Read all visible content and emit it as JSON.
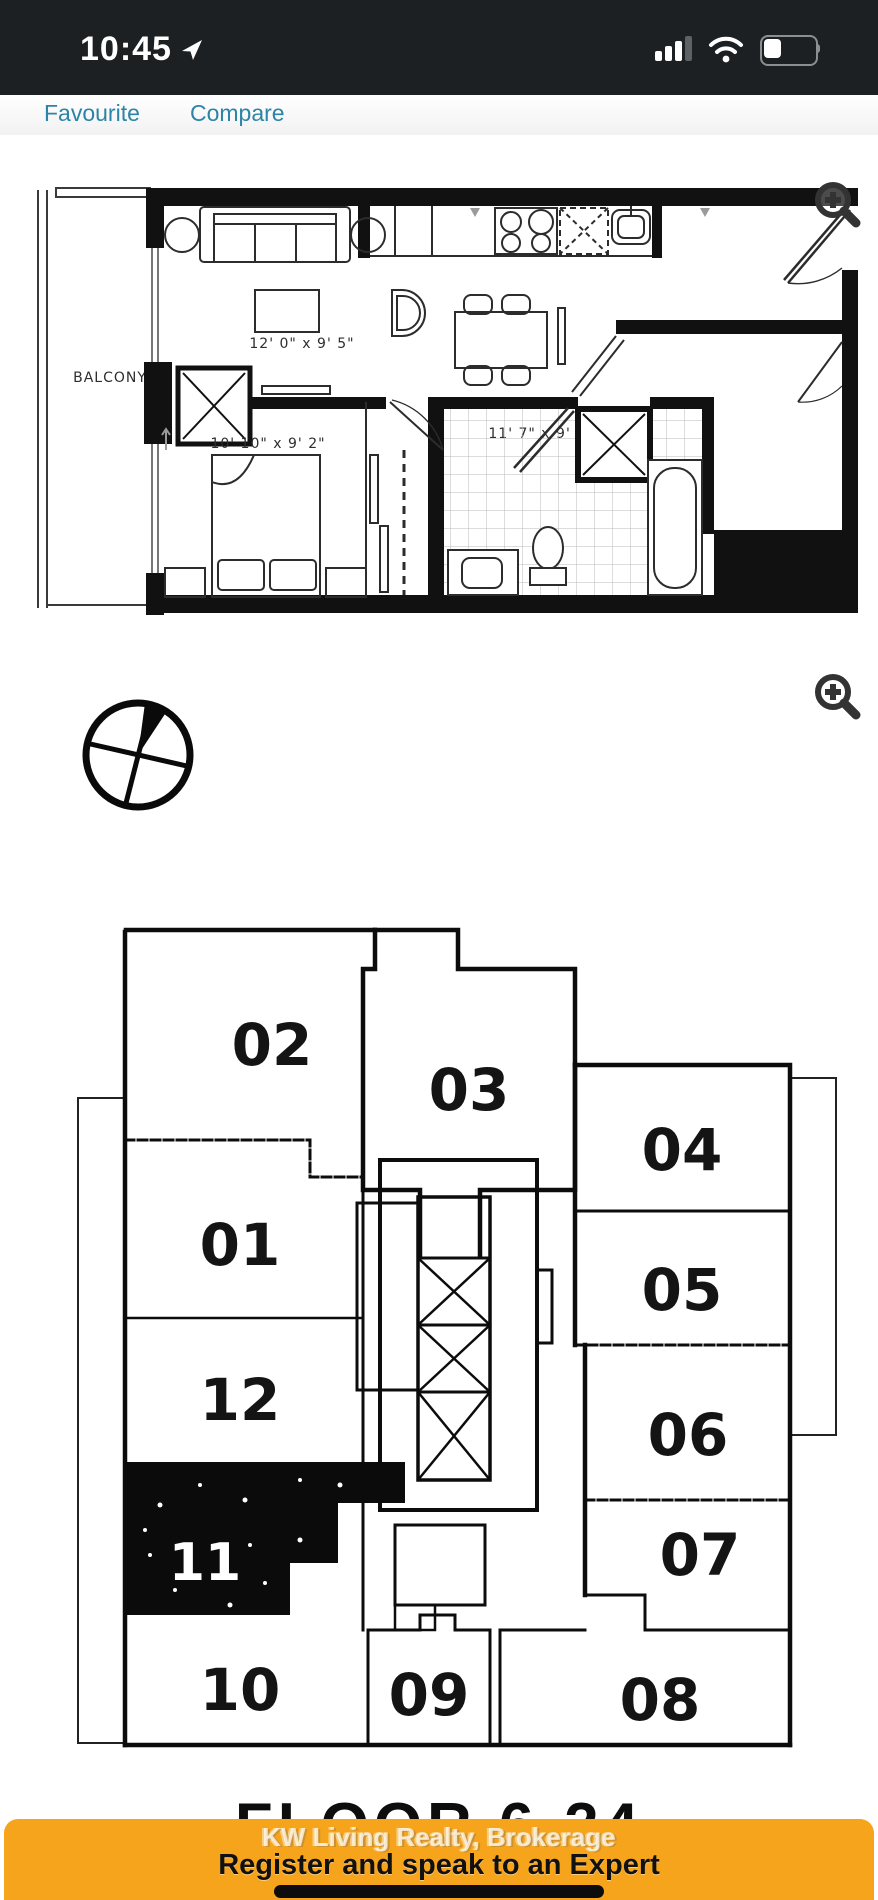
{
  "status_bar": {
    "time": "10:45"
  },
  "header": {
    "favourite_label": "Favourite",
    "compare_label": "Compare"
  },
  "floor_plan": {
    "balcony_label": "BALCONY",
    "living_dim": "12' 0\" x 9' 5\"",
    "kitchen_dim": "11' 7\" x 9' 5\"",
    "bedroom_dim": "10' 10\" x 9' 2\""
  },
  "key_plan": {
    "floor_label": "FLOOR 6-24",
    "highlighted_unit": "11",
    "units": [
      {
        "label": "02"
      },
      {
        "label": "03"
      },
      {
        "label": "04"
      },
      {
        "label": "01"
      },
      {
        "label": "05"
      },
      {
        "label": "12"
      },
      {
        "label": "06"
      },
      {
        "label": "11"
      },
      {
        "label": "07"
      },
      {
        "label": "10"
      },
      {
        "label": "09"
      },
      {
        "label": "08"
      }
    ]
  },
  "banner": {
    "watermark": "KW Living Realty, Brokerage",
    "cta": "Register and speak to an Expert",
    "background_color": "#F6A41B"
  },
  "icons": {
    "location": "navigation-arrow-icon",
    "signal": "cellular-signal-icon",
    "wifi": "wifi-icon",
    "battery": "battery-icon",
    "zoom": "magnifier-plus-icon",
    "compass": "compass-rose-icon"
  },
  "colors": {
    "link": "#2C84A6",
    "status_bar_bg": "#1C2022",
    "plan_ink": "#111111"
  }
}
